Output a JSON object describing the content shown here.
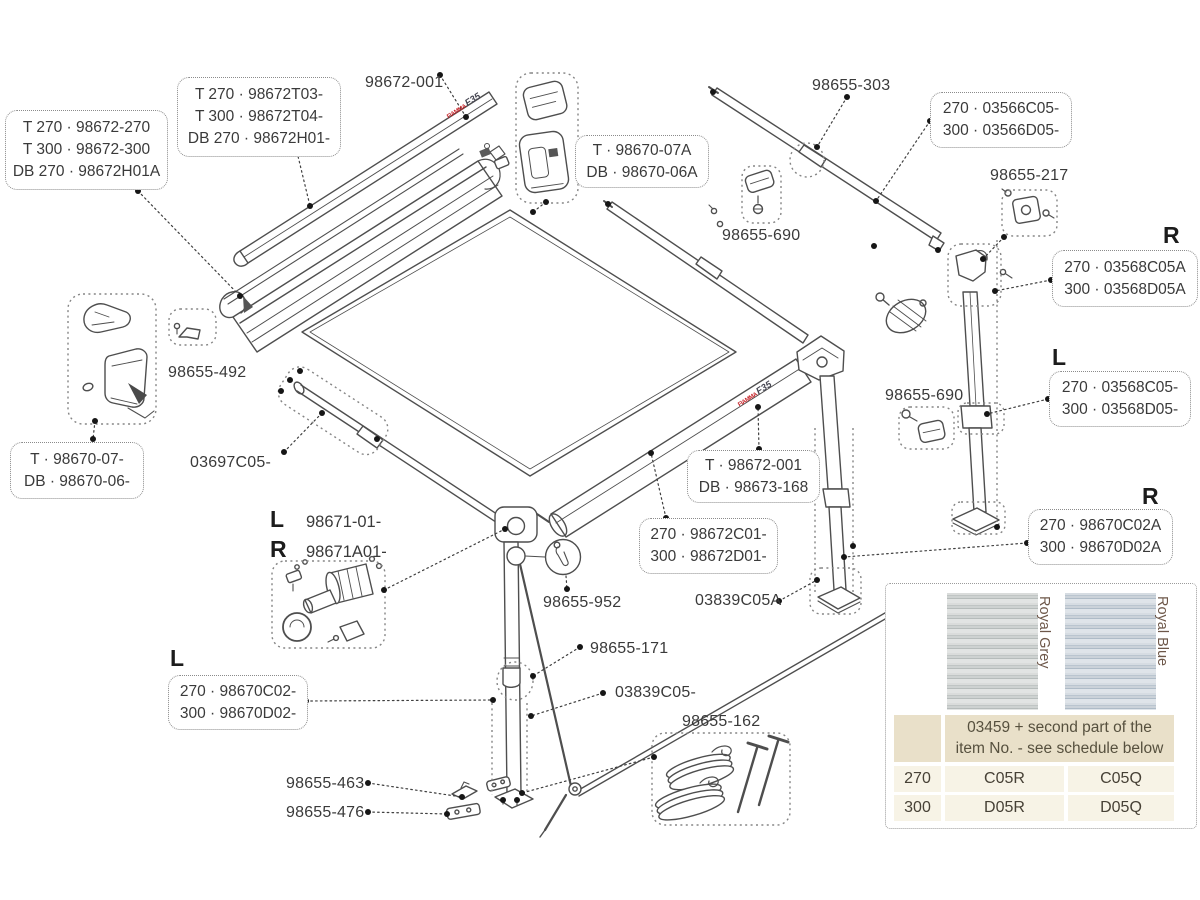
{
  "logo": {
    "brand": "FIAMMA",
    "model": "F35"
  },
  "plain_labels": [
    {
      "id": "98672-001",
      "text": "98672-001",
      "x": 365,
      "y": 74
    },
    {
      "id": "98655-303",
      "text": "98655-303",
      "x": 812,
      "y": 77
    },
    {
      "id": "98655-690-top",
      "text": "98655-690",
      "x": 722,
      "y": 227
    },
    {
      "id": "98655-217",
      "text": "98655-217",
      "x": 990,
      "y": 167
    },
    {
      "id": "98655-492",
      "text": "98655-492",
      "x": 168,
      "y": 364
    },
    {
      "id": "03697C05",
      "text": "03697C05-",
      "x": 190,
      "y": 454
    },
    {
      "id": "98655-952",
      "text": "98655-952",
      "x": 543,
      "y": 594
    },
    {
      "id": "98655-171",
      "text": "98655-171",
      "x": 590,
      "y": 640
    },
    {
      "id": "03839C05",
      "text": "03839C05-",
      "x": 615,
      "y": 684
    },
    {
      "id": "03839C05A",
      "text": "03839C05A",
      "x": 695,
      "y": 592
    },
    {
      "id": "98655-162",
      "text": "98655-162",
      "x": 682,
      "y": 713
    },
    {
      "id": "98655-463",
      "text": "98655-463",
      "x": 286,
      "y": 775
    },
    {
      "id": "98655-476",
      "text": "98655-476",
      "x": 286,
      "y": 804
    },
    {
      "id": "98655-690-right",
      "text": "98655-690",
      "x": 885,
      "y": 387
    }
  ],
  "letter_headings": [
    {
      "id": "r-top",
      "text": "R",
      "x": 1163,
      "y": 222
    },
    {
      "id": "l-right",
      "text": "L",
      "x": 1052,
      "y": 344
    },
    {
      "id": "l-left",
      "text": "L",
      "x": 170,
      "y": 645
    },
    {
      "id": "r-bottom",
      "text": "R",
      "x": 1142,
      "y": 483
    }
  ],
  "dotted_boxes": [
    {
      "id": "lead-bar-set",
      "lines": [
        "T 270 · 98672-270",
        "T 300 · 98672-300",
        "DB 270 · 98672H01A"
      ],
      "x": 5,
      "y": 110,
      "w": 163,
      "h": 80
    },
    {
      "id": "lead-bar-alt",
      "lines": [
        "T 270 · 98672T03-",
        "T 300 · 98672T04-",
        "DB 270 · 98672H01-"
      ],
      "x": 177,
      "y": 77,
      "w": 164,
      "h": 80
    },
    {
      "id": "support-arm",
      "lines": [
        "270 · 03566C05-",
        "300 · 03566D05-"
      ],
      "x": 930,
      "y": 92,
      "w": 142,
      "h": 56
    },
    {
      "id": "endcap-a",
      "lines": [
        "T · 98670-07A",
        "DB · 98670-06A"
      ],
      "x": 575,
      "y": 135,
      "w": 134,
      "h": 53
    },
    {
      "id": "leg-upper-r",
      "lines": [
        "270 · 03568C05A",
        "300 · 03568D05A"
      ],
      "x": 1052,
      "y": 250,
      "w": 146,
      "h": 57
    },
    {
      "id": "leg-upper-l",
      "lines": [
        "270 · 03568C05-",
        "300 · 03568D05-"
      ],
      "x": 1049,
      "y": 371,
      "w": 142,
      "h": 56
    },
    {
      "id": "endcap-b",
      "lines": [
        "T · 98670-07-",
        "DB · 98670-06-"
      ],
      "x": 10,
      "y": 442,
      "w": 134,
      "h": 57
    },
    {
      "id": "roller-t",
      "lines": [
        "T · 98672-001",
        "DB · 98673-168"
      ],
      "x": 687,
      "y": 450,
      "w": 133,
      "h": 53
    },
    {
      "id": "roller-lr",
      "lines": [
        "270 · 98672C01-",
        "300 · 98672D01-"
      ],
      "x": 639,
      "y": 518,
      "w": 139,
      "h": 56
    },
    {
      "id": "leg-l",
      "lines": [
        "270 · 98670C02-",
        "300 · 98670D02-"
      ],
      "x": 168,
      "y": 675,
      "w": 140,
      "h": 55
    },
    {
      "id": "leg-r",
      "lines": [
        "270 · 98670C02A",
        "300 · 98670D02A"
      ],
      "x": 1028,
      "y": 509,
      "w": 145,
      "h": 56
    }
  ],
  "lr_legend": {
    "l_letter": "L",
    "l_code": "98671-01-",
    "r_letter": "R",
    "r_code": "98671A01-"
  },
  "table_panel": {
    "swatches": [
      {
        "name": "Royal Grey"
      },
      {
        "name": "Royal Blue"
      }
    ],
    "schedule_header": "03459 + second part of the item No. - see schedule below",
    "rows": [
      {
        "size": "270",
        "left": "C05R",
        "right": "C05Q"
      },
      {
        "size": "300",
        "left": "D05R",
        "right": "D05Q"
      }
    ]
  }
}
